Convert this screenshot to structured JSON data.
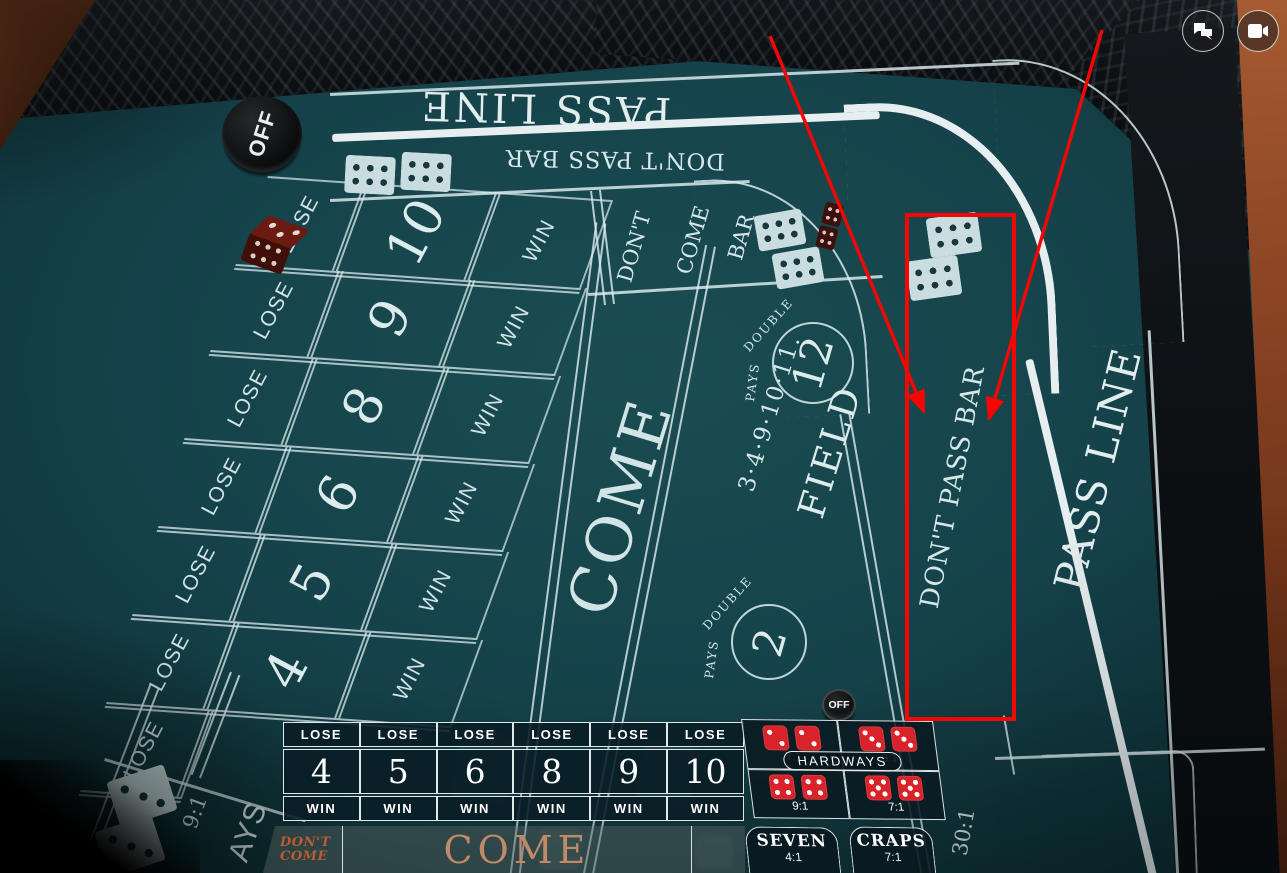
{
  "ui": {
    "chat_icon": "chat-bubbles-icon",
    "camera_icon": "video-camera-icon"
  },
  "annotations": {
    "accent_color": "#f40603"
  },
  "felt": {
    "pass_line_top": "PASS LINE",
    "dont_pass_bar_top": "DON'T PASS BAR",
    "lose": "LOSE",
    "win": "WIN",
    "points": [
      "10",
      "9",
      "8",
      "6",
      "5",
      "4"
    ],
    "come": "COME",
    "dont_come_bar": [
      "DON'T",
      "COME",
      "BAR"
    ],
    "field": {
      "pays": "PAYS",
      "double": "DOUBLE",
      "twelve": "12",
      "two": "2",
      "numbers": "3·4·9·10·11.",
      "label": "FIELD"
    },
    "dont_pass_bar_side": "DON'T PASS BAR",
    "pass_line_side": "PASS LINE",
    "puck_off": "OFF",
    "button_off": "OFF",
    "corner_ratio": "9:1",
    "corner_partial": "AYS",
    "thirty_to_one": "30:1",
    "dice_six": 6,
    "dice_three": 3
  },
  "bet_panel": {
    "lose": "LOSE",
    "win": "WIN",
    "points": [
      "4",
      "5",
      "6",
      "8",
      "9",
      "10"
    ],
    "dont_come_line1": "DON'T",
    "dont_come_line2": "COME",
    "come": "COME",
    "hardways": {
      "label": "HARDWAYS",
      "cells": [
        {
          "die": 2,
          "ratio": "7:1"
        },
        {
          "die": 3,
          "ratio": "9:1"
        },
        {
          "die": 4,
          "ratio": "9:1"
        },
        {
          "die": 5,
          "ratio": "7:1"
        }
      ]
    },
    "seven": {
      "label": "SEVEN",
      "ratio": "4:1"
    },
    "craps": {
      "label": "CRAPS",
      "ratio": "7:1"
    },
    "colors": {
      "dice_red": "#d8232a",
      "come_text": "#c08a66",
      "dont_come_text": "#b85c33"
    }
  }
}
